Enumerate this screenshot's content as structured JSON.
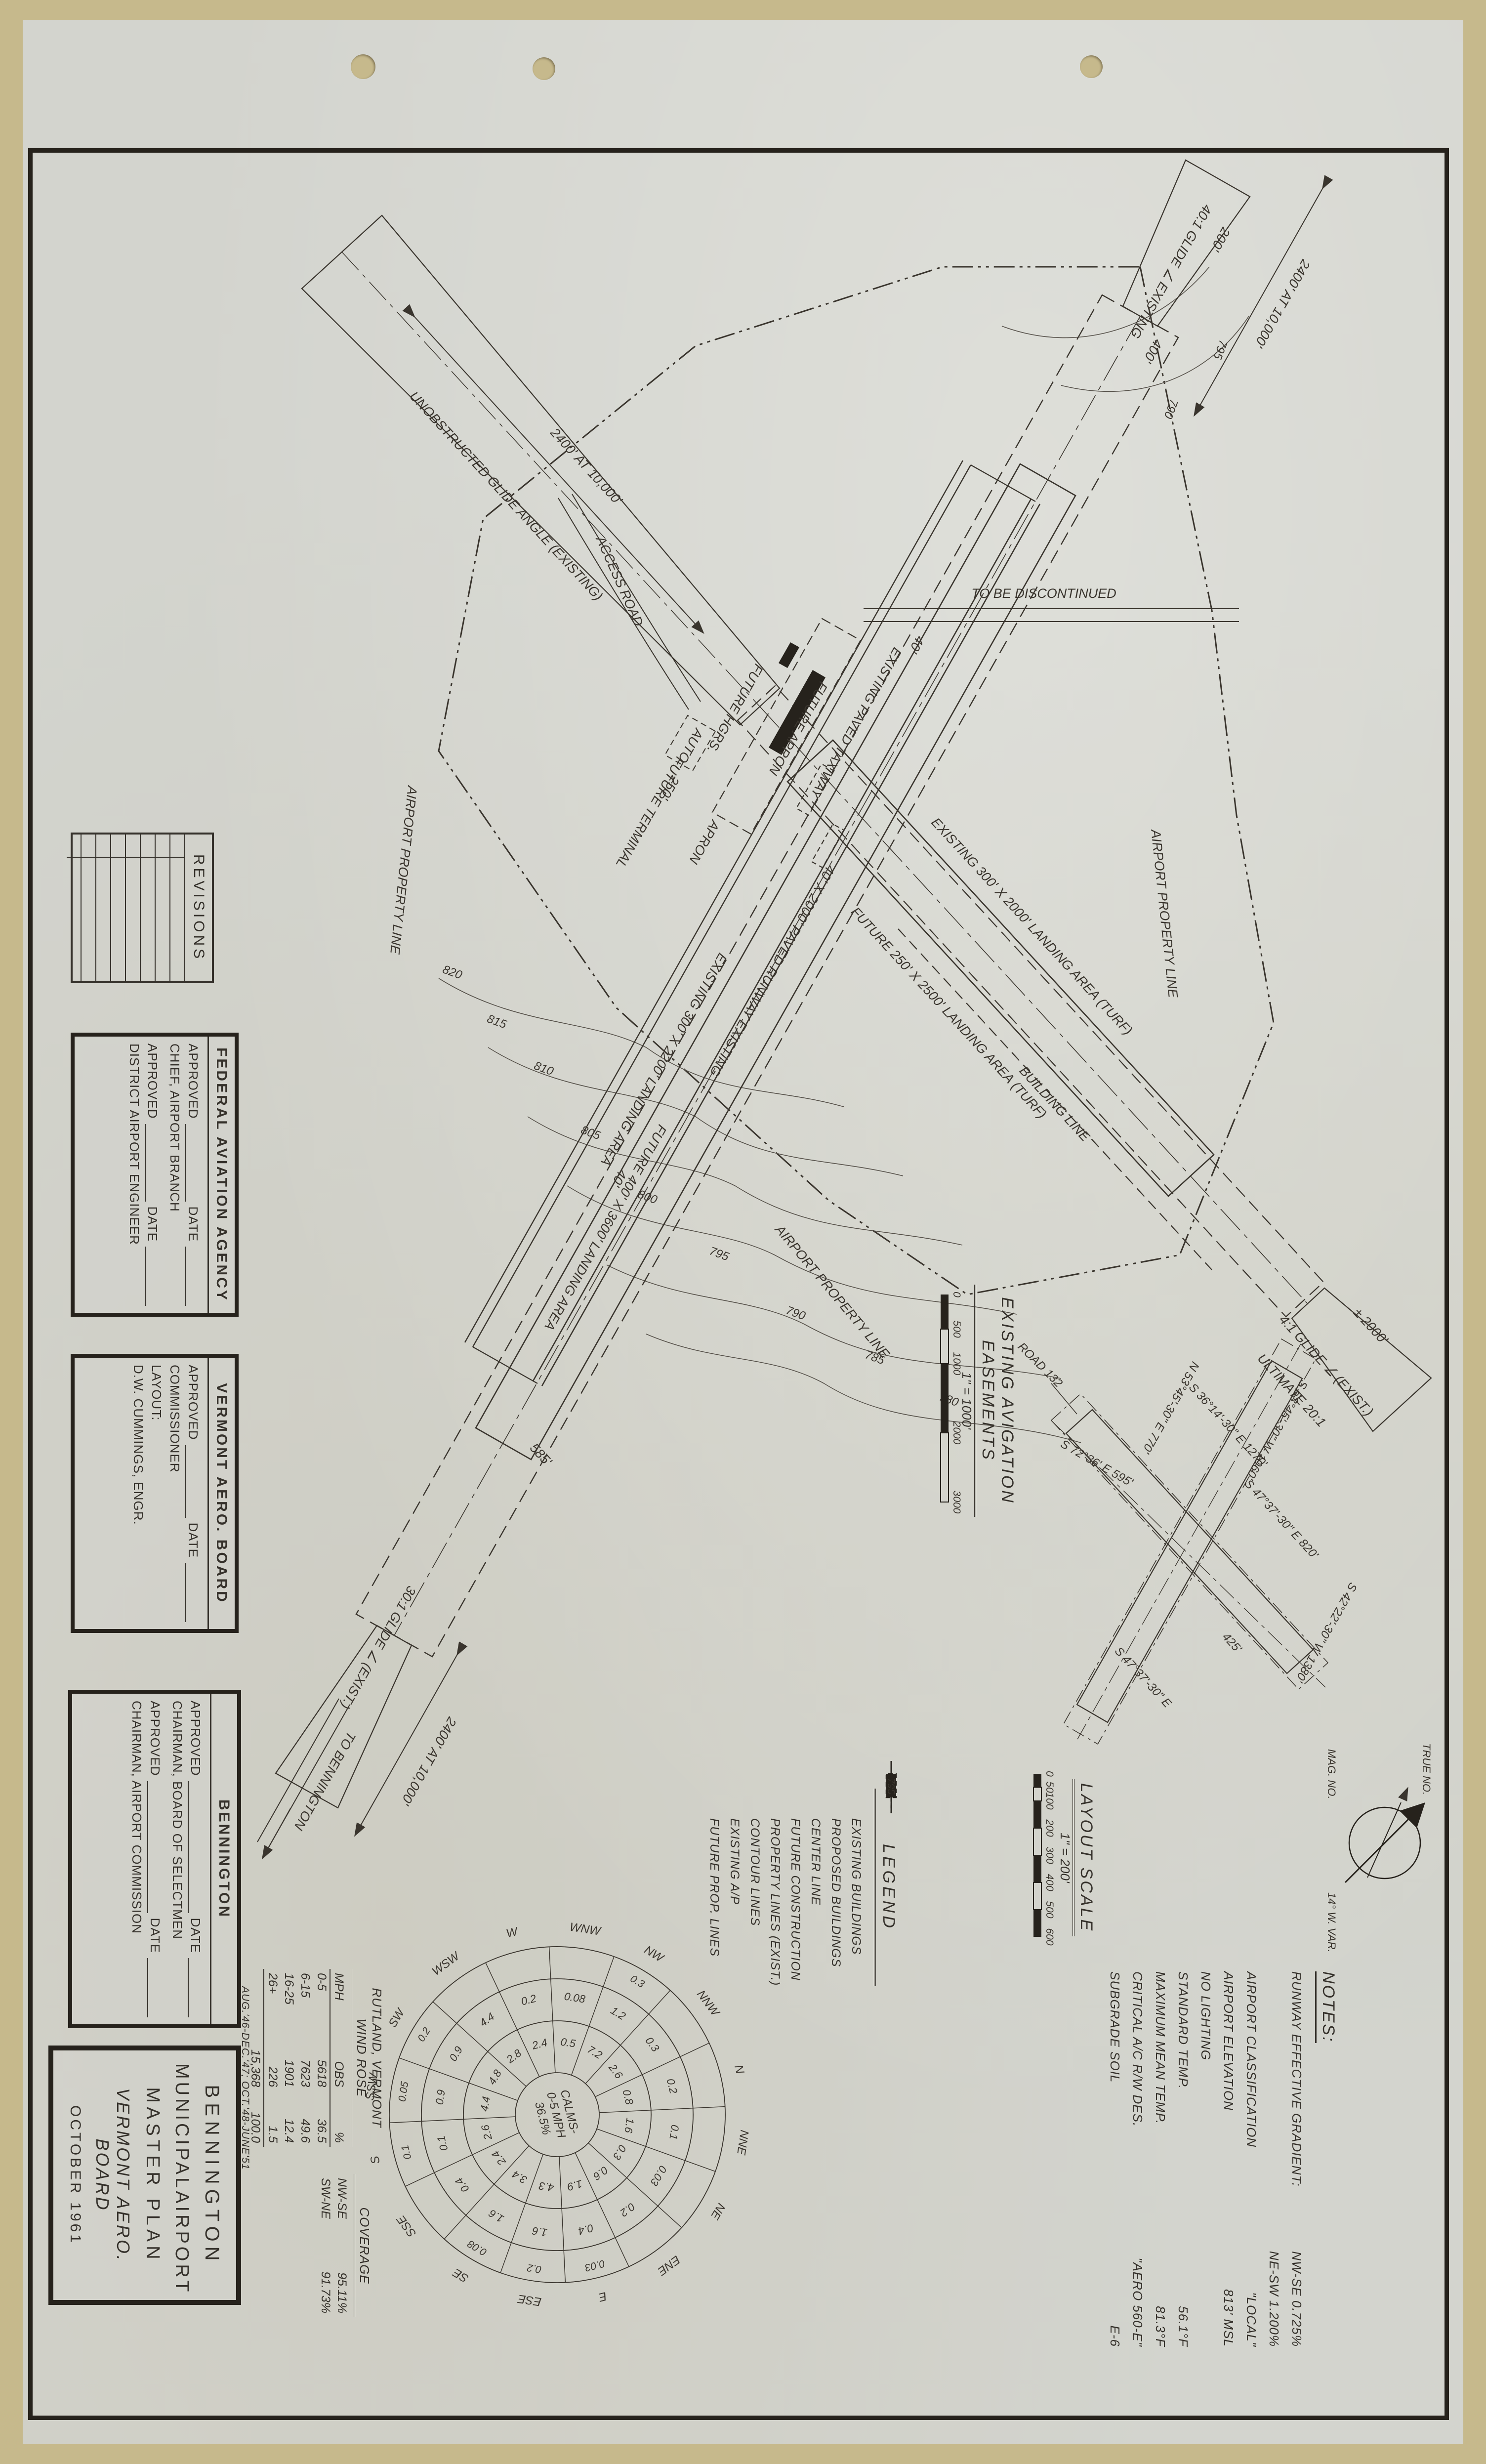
{
  "title_block": {
    "line1": "BENNINGTON",
    "line2_left": "MUNICIPAL",
    "line2_right": "AIRPORT",
    "line3": "MASTER PLAN",
    "line4": "VERMONT AERO. BOARD",
    "line5": "OCTOBER 1961"
  },
  "approvals": {
    "faa": {
      "title": "FEDERAL AVIATION AGENCY",
      "approved_label": "APPROVED",
      "date_label": "DATE",
      "role1": "CHIEF, AIRPORT BRANCH",
      "role2": "DISTRICT AIRPORT ENGINEER"
    },
    "vermont": {
      "title": "VERMONT AERO. BOARD",
      "approved_label": "APPROVED",
      "date_label": "DATE",
      "role1": "COMMISSIONER",
      "layout_label": "LAYOUT:",
      "engineer": "D.W. CUMMINGS, ENGR."
    },
    "bennington": {
      "title": "BENNINGTON",
      "approved_label": "APPROVED",
      "date_label": "DATE",
      "role1": "CHAIRMAN, BOARD OF SELECTMEN",
      "role2": "CHAIRMAN, AIRPORT COMMISSION"
    }
  },
  "revisions": {
    "title": "REVISIONS"
  },
  "legend": {
    "title": "LEGEND",
    "contour_value": "795",
    "items": [
      "EXISTING BUILDINGS",
      "PROPOSED BUILDINGS",
      "CENTER LINE",
      "FUTURE CONSTRUCTION",
      "PROPERTY LINES (EXIST.)",
      "CONTOUR LINES",
      "EXISTING A/P",
      "FUTURE PROP. LINES"
    ]
  },
  "notes": {
    "title": "NOTES:",
    "rows": [
      {
        "label": "RUNWAY EFFECTIVE GRADIENT:",
        "value": "NW-SE  0.725%"
      },
      {
        "label": "",
        "value": "NE-SW  1.200%"
      },
      {
        "label": "AIRPORT CLASSIFICATION",
        "value": "\"LOCAL\""
      },
      {
        "label": "AIRPORT ELEVATION",
        "value": "813' MSL"
      },
      {
        "label": "NO LIGHTING",
        "value": ""
      },
      {
        "label": "STANDARD TEMP.",
        "value": "56.1°F"
      },
      {
        "label": "MAXIMUM MEAN TEMP.",
        "value": "81.3°F"
      },
      {
        "label": "CRITICAL A/C R/W DES.",
        "value": "\"AERO 560-E\""
      },
      {
        "label": "SUBGRADE SOIL",
        "value": "E-6"
      }
    ]
  },
  "layout_scale": {
    "title": "LAYOUT SCALE",
    "ratio": "1\" = 200'",
    "ticks": [
      "0",
      "50",
      "100",
      "200",
      "300",
      "400",
      "500",
      "600"
    ]
  },
  "north_arrow": {
    "true_label": "TRUE NO.",
    "mag_label": "MAG. NO.",
    "variation": "14° W. VAR."
  },
  "inset": {
    "title": "EXISTING AVIGATION EASEMENTS",
    "ratio": "1\" = 1000'",
    "ticks": [
      "0",
      "500",
      "1000",
      "2000",
      "3000"
    ],
    "road": "ROAD 132",
    "bearings": [
      "S 53°45'-30\" W  1060'",
      "S 42°22'-30\" W  1380'",
      "N 53°45'-30\" E  770'",
      "S 47°37'-30\" E  820'",
      "S 36°14'-30\" E  1270'",
      "S 72°36' E  595'",
      "425'",
      "S 47°37'-30\" E"
    ]
  },
  "wind_rose": {
    "table": {
      "title": "RUTLAND, VERMONT WIND ROSE",
      "headers": [
        "MPH",
        "OBS",
        "%"
      ],
      "rows": [
        [
          "0-5",
          "5618",
          "36.5"
        ],
        [
          "6-15",
          "7623",
          "49.6"
        ],
        [
          "16-25",
          "1901",
          "12.4"
        ],
        [
          "26+",
          "226",
          "1.5"
        ]
      ],
      "totals": [
        "",
        "15,368",
        "100.0"
      ]
    },
    "coverage": {
      "title": "COVERAGE",
      "rows": [
        [
          "NW-SE",
          "95.11%"
        ],
        [
          "SW-NE",
          "91.73%"
        ]
      ]
    },
    "period": "AUG.'46-DEC.'47;  OCT.'48-JUNE'51",
    "center": [
      "CALMS-",
      "0-5 MPH",
      "36.5%"
    ],
    "directions": [
      "N",
      "NNE",
      "NE",
      "ENE",
      "E",
      "ESE",
      "SE",
      "SSE",
      "S",
      "SSW",
      "SW",
      "WSW",
      "W",
      "WNW",
      "NW",
      "NNW"
    ],
    "values_6_15": [
      "0.8",
      "1.6",
      "0.3",
      "0.6",
      "1.9",
      "4.3",
      "3.4",
      "2.4",
      "2.6",
      "4.4",
      "4.8",
      "2.8",
      "2.4",
      "0.5",
      "7.2",
      "2.6"
    ],
    "values_16_25": [
      "0.2",
      "0.1",
      "0.03",
      "0.2",
      "0.4",
      "1.6",
      "1.6",
      "0.4",
      "0.1",
      "0.9",
      "0.9",
      "4.4",
      "0.2",
      "0.08",
      "1.2",
      "0.3"
    ],
    "values_26_plus": [
      "",
      "",
      "",
      "",
      "0.03",
      "0.2",
      "0.08",
      "",
      "0.1",
      "0.05",
      "0.2",
      "",
      "",
      "",
      "0.3",
      ""
    ]
  },
  "plan": {
    "property_line": "AIRPORT PROPERTY LINE",
    "building_line": "BUILDING LINE",
    "taxiway": "EXISTING PAVED TAXIWAY",
    "paved_runway": "40' X 2000' PAVED RUNWAY EXISTING",
    "existing_landing_area": "EXISTING 300' X 2200' LANDING AREA",
    "future_landing_area": "FUTURE 400' X 3600' LANDING AREA",
    "existing_turf": "EXISTING 300' X 2000' LANDING AREA (TURF)",
    "future_turf": "FUTURE 250' X 2500' LANDING AREA (TURF)",
    "nw_dim": "2400' AT 10,000'",
    "nw_glide": "40:1 GLIDE ∠ EXISTING",
    "se_dim": "2400' AT 10,000'",
    "se_glide": "30:1 GLIDE ∠ (EXIST.)",
    "ne_glide": "4:1 GLIDE ∠ (EXIST.)",
    "ne_ult": "ULTIMATE 20:1",
    "ne_dim": "± 2000'",
    "sw_corridor": "UNOBSTRUCTED GLIDE ANGLE (EXISTING)",
    "sw_dim": "2400' AT 10,000'",
    "discontinued": "TO BE DISCONTINUED",
    "to_bennington": "TO BENNINGTON",
    "access_road": "ACCESS ROAD",
    "future_terminal": "FUTURE TERMINAL",
    "future_hgrs": "FUTURE HGRS.",
    "future_apron": "FUTURE APRON",
    "apron": "APRON",
    "auto": "AUTO",
    "dim_585": "585'",
    "dim_250": "250'",
    "dim_40": "40'",
    "dim_400": "400'",
    "dim_200": "200'",
    "contours": [
      "780",
      "785",
      "790",
      "795",
      "800",
      "805",
      "810",
      "815",
      "820",
      "795",
      "790"
    ]
  }
}
